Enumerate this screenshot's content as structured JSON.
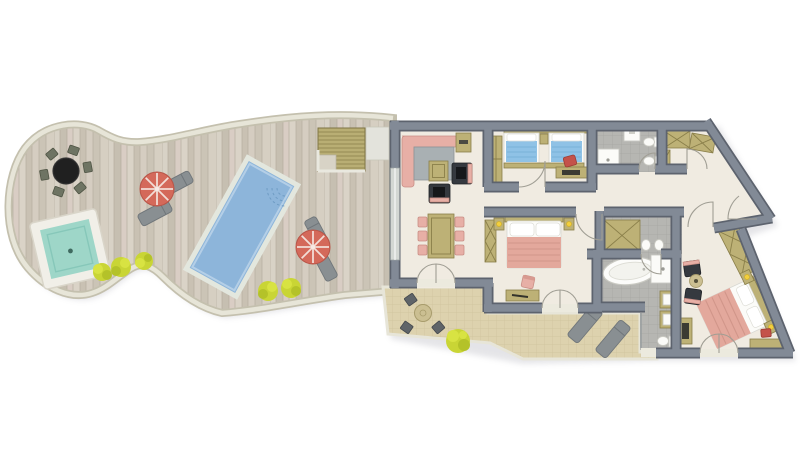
{
  "title": "Penthouse suite floor plan with pool deck",
  "canvas": {
    "width": 800,
    "height": 450
  },
  "colors": {
    "background": "#ffffff",
    "plank_base": "#cfc8bb",
    "deck_edge": "#e7e5d8",
    "wall": "#828a96",
    "wall_edge": "#5d636e",
    "floor": "#f0ebe1",
    "bath_tile": "#b6b6b2",
    "terrace_tile": "#ddd2ae",
    "pool": "#8db5da",
    "pool_coping": "#e3e7de",
    "spa_water": "#9ed6c8",
    "spa_frame": "#f1efe8",
    "umbrella": "#d4695a",
    "lounger": "#898f92",
    "bush": "#c9d535",
    "khaki_furniture": "#bdb176",
    "sofa_pink": "#e7afa6",
    "seat_gray": "#a9b0b3",
    "chair_dark": "#35393f",
    "bed_blue": "#8fc2e6",
    "bed_pink": "#e3a89c",
    "mattress_white": "#fbfbf8",
    "lamp_glow": "#f2cf3e",
    "accent_red": "#c4524a",
    "table_black": "#202020",
    "door_arc": "#a09e94",
    "glass": "#d3d7d3",
    "pergola": "#b9ae74"
  },
  "outdoor": {
    "deck": {
      "material": "wood plank deck, organic curved outline",
      "items": [
        "round dining table with 6 chairs",
        "square hot tub",
        "rectangular pool (rotated)",
        "2 coral parasols",
        "4 sun loungers",
        "slatted pergola cabin",
        "5 yellow shrubs"
      ]
    },
    "terrace": {
      "material": "beige stone tiles",
      "items": [
        "bistro table with 3 chairs",
        "2 sun loungers",
        "yellow shrub"
      ]
    }
  },
  "indoor": {
    "rooms": [
      "living-dining room",
      "twin bedroom",
      "shower room",
      "walk-in closet",
      "hallway",
      "double bedroom",
      "vanity room",
      "master bathroom",
      "master bedroom"
    ],
    "fixtures": [
      "freestanding bathtub",
      "2 showers",
      "double vanity",
      "3 toilets",
      "2 wall basins",
      "6 wardrobes"
    ]
  }
}
